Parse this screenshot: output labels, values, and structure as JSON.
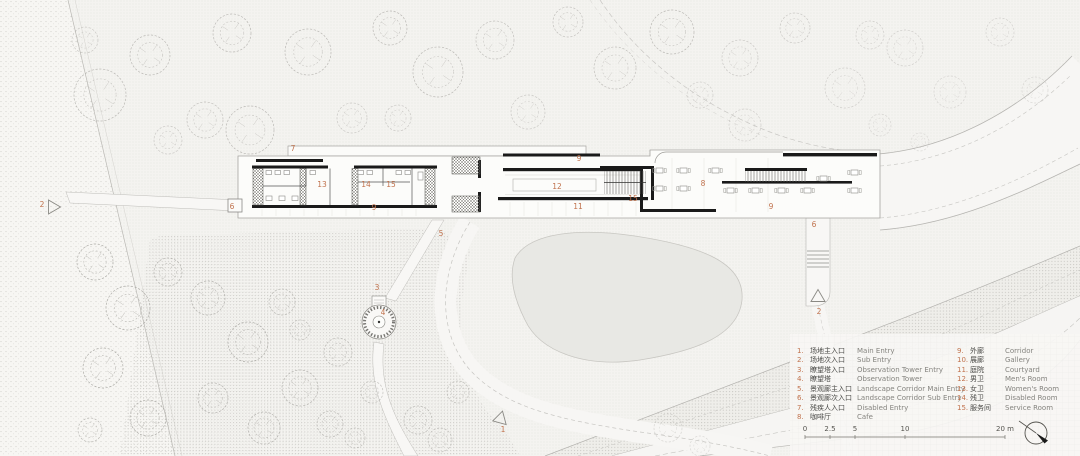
{
  "drawing": {
    "type": "architectural-site-plan",
    "colors": {
      "paper": "#f4f3f0",
      "wall": "#1a1a1a",
      "accent_label": "#c1734e",
      "pond_fill": "#e8e8e4",
      "tree_stroke": "#b3b2ad"
    }
  },
  "plan": {
    "markers": [
      {
        "label": "7",
        "x": 293,
        "y": 151
      },
      {
        "label": "13",
        "x": 322,
        "y": 187
      },
      {
        "label": "14",
        "x": 366,
        "y": 187
      },
      {
        "label": "15",
        "x": 391,
        "y": 187
      },
      {
        "label": "9",
        "x": 374,
        "y": 210
      },
      {
        "label": "6",
        "x": 232,
        "y": 209
      },
      {
        "label": "5",
        "x": 441,
        "y": 236
      },
      {
        "label": "9",
        "x": 579,
        "y": 161
      },
      {
        "label": "12",
        "x": 557,
        "y": 189
      },
      {
        "label": "11",
        "x": 578,
        "y": 209
      },
      {
        "label": "15",
        "x": 633,
        "y": 201
      },
      {
        "label": "8",
        "x": 703,
        "y": 186
      },
      {
        "label": "9",
        "x": 771,
        "y": 209
      },
      {
        "label": "6",
        "x": 814,
        "y": 227
      },
      {
        "label": "2",
        "x": 819,
        "y": 314
      },
      {
        "label": "3",
        "x": 377,
        "y": 290
      },
      {
        "label": "4",
        "x": 383,
        "y": 315
      },
      {
        "label": "2",
        "x": 42,
        "y": 207
      },
      {
        "label": "1",
        "x": 503,
        "y": 432
      }
    ],
    "entry_triangles": [
      {
        "x": 53,
        "y": 207,
        "rot": 90
      },
      {
        "x": 818,
        "y": 297,
        "rot": 0
      },
      {
        "x": 500,
        "y": 419,
        "rot": -105
      }
    ]
  },
  "legend": {
    "left": [
      {
        "no": "1.",
        "zh": "场地主入口",
        "en": "Main Entry"
      },
      {
        "no": "2.",
        "zh": "场地次入口",
        "en": "Sub Entry"
      },
      {
        "no": "3.",
        "zh": "瞭望塔入口",
        "en": "Observation Tower Entry"
      },
      {
        "no": "4.",
        "zh": "瞭望塔",
        "en": "Observation Tower"
      },
      {
        "no": "5.",
        "zh": "景观廊主入口",
        "en": "Landscape Corridor Main Entry"
      },
      {
        "no": "6.",
        "zh": "景观廊次入口",
        "en": "Landscape Corridor Sub Entry"
      },
      {
        "no": "7.",
        "zh": "残疾人入口",
        "en": "Disabled Entry"
      },
      {
        "no": "8.",
        "zh": "咖啡厅",
        "en": "Cafe"
      }
    ],
    "right": [
      {
        "no": "9.",
        "zh": "外廊",
        "en": "Corridor"
      },
      {
        "no": "10.",
        "zh": "展廊",
        "en": "Gallery"
      },
      {
        "no": "11.",
        "zh": "庭院",
        "en": "Courtyard"
      },
      {
        "no": "12.",
        "zh": "男卫",
        "en": "Men's Room"
      },
      {
        "no": "13.",
        "zh": "女卫",
        "en": "Women's Room"
      },
      {
        "no": "14.",
        "zh": "残卫",
        "en": "Disabled Room"
      },
      {
        "no": "15.",
        "zh": "服务间",
        "en": "Service Room"
      }
    ]
  },
  "scalebar": {
    "unit_labels": [
      {
        "text": "0",
        "m": 0
      },
      {
        "text": "2.5",
        "m": 2.5
      },
      {
        "text": "5",
        "m": 5
      },
      {
        "text": "10",
        "m": 10
      },
      {
        "text": "20 m",
        "m": 20
      }
    ]
  }
}
